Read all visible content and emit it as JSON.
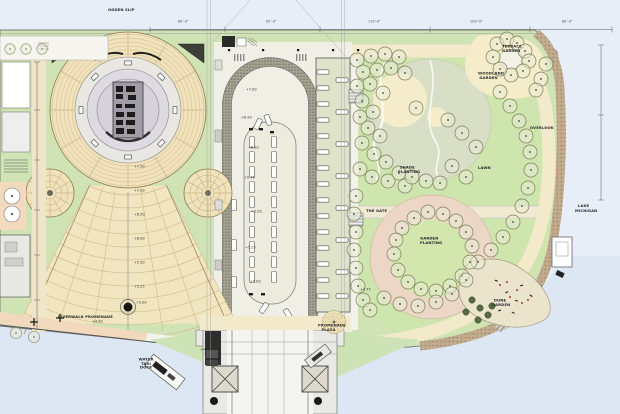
{
  "meta": {
    "title": "Waterfront Park Site Plan"
  },
  "plan": {
    "labels": [
      {
        "id": "ogden-slip",
        "text": "OGDEN SLIP"
      },
      {
        "id": "lake-line1",
        "text": "LAKE"
      },
      {
        "id": "lake-line2",
        "text": "MICHIGAN"
      },
      {
        "id": "lawn",
        "text": "LAWN"
      },
      {
        "id": "shade-planting",
        "text": "SHADE PLANTING"
      },
      {
        "id": "garden-planting",
        "text": "GARDEN PLANTING"
      },
      {
        "id": "the-gate",
        "text": "THE GATE"
      },
      {
        "id": "terrace-garden",
        "text": "TERRACE GARDEN"
      },
      {
        "id": "woodland-garden",
        "text": "WOODLAND GARDEN"
      },
      {
        "id": "overlook",
        "text": "OVERLOOK"
      },
      {
        "id": "promenade-plaza",
        "text": "PROMENADE PLAZA"
      },
      {
        "id": "riverwalk",
        "text": "RIVERWALK PROMENADE"
      },
      {
        "id": "dune-garden",
        "text": "DUNE GARDEN"
      },
      {
        "id": "water-taxi",
        "text": "WATER TAXI DOCK"
      }
    ],
    "spot_elevations": [
      "+7.50",
      "+7.00",
      "+6.50",
      "+6.00",
      "+5.50",
      "+5.25",
      "+5.00",
      "+7.00",
      "+6.50",
      "+6.00",
      "+5.75",
      "+5.50",
      "+5.25",
      "+5.00",
      "+4.75",
      "+4.50",
      "+4.50"
    ],
    "dimensions": [
      "60'-0\"",
      "85'-0\"",
      "110'-0\"",
      "100'-0\"",
      "80'-0\""
    ],
    "colors": {
      "water": "#dde7f3",
      "paper": "#e8eef7",
      "park_green": "#cfe3b5",
      "lawn_bright": "#cfe5ae",
      "meadow_gray_green": "#d9dec6",
      "paving_cream": "#f3e9cb",
      "amphitheater_tan": "#f0e2ba",
      "planting_pink": "#ecd7c6",
      "shore_salmon": "#f2d9bd",
      "boardwalk_brown": "#c2aa8d",
      "median_speckle": "#a5a493",
      "lot_sage": "#e0e3cb",
      "structure_dark": "#2a2a28"
    }
  }
}
